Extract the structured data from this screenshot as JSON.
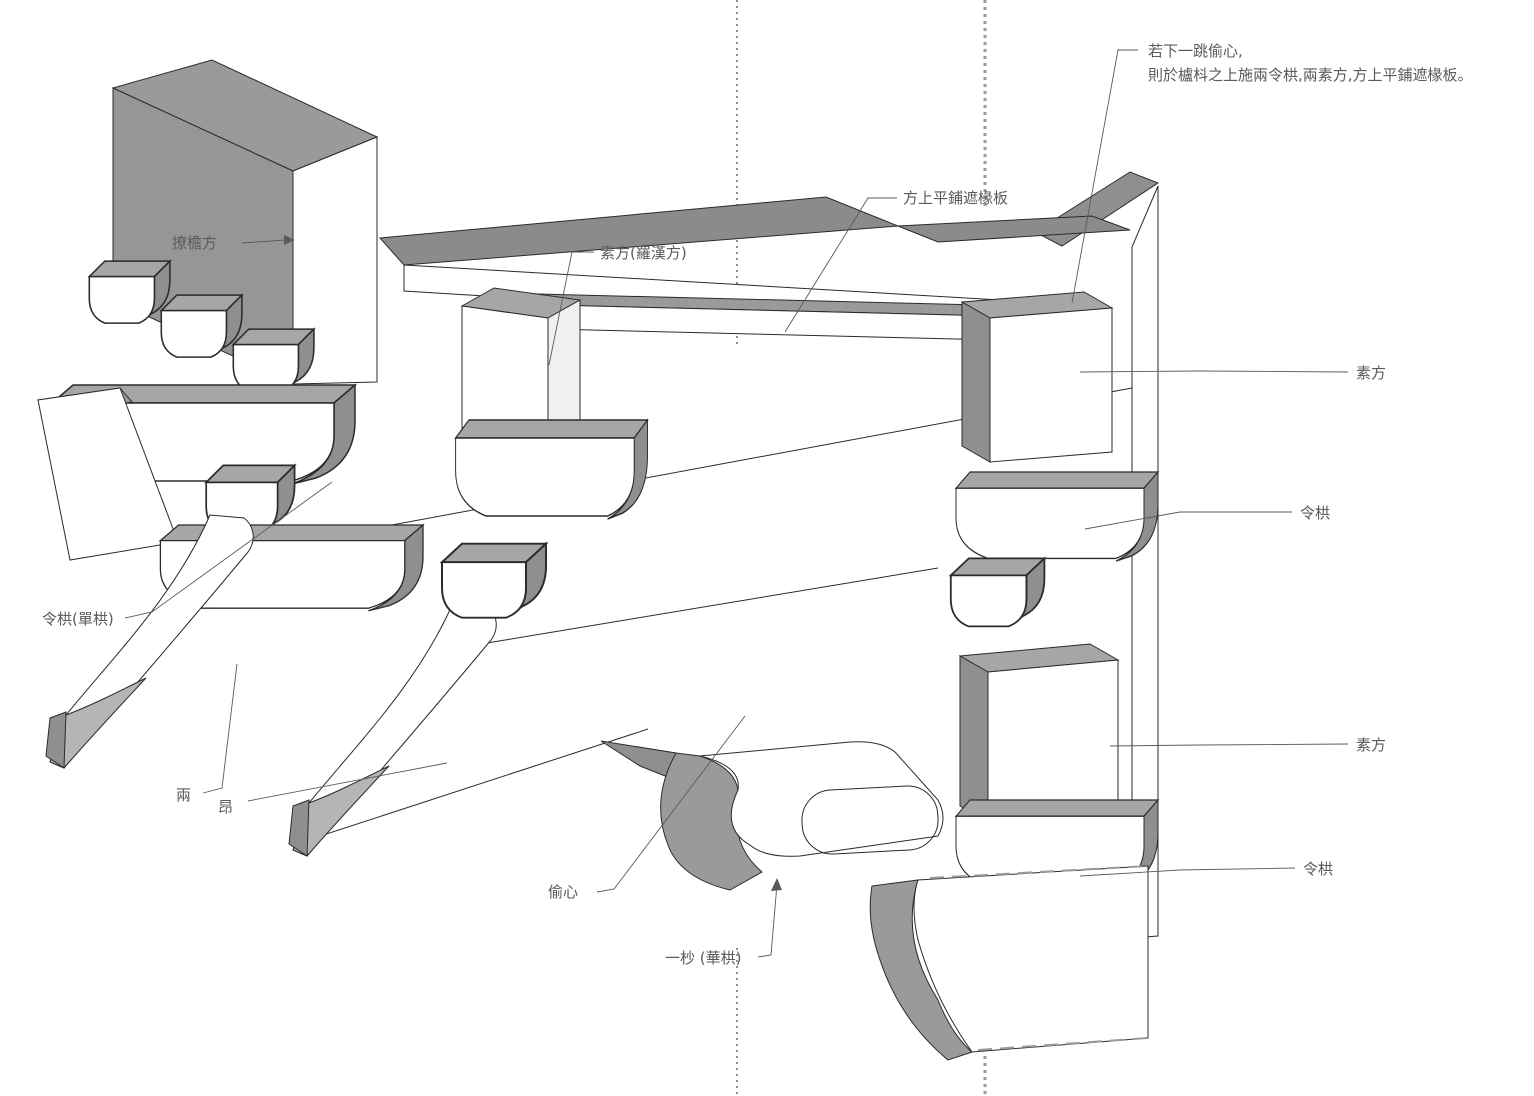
{
  "figure": {
    "note": {
      "line1": "若下一跳偷心,",
      "line2": "則於櫨枓之上施兩令栱,兩素方,方上平鋪遮椽板。"
    },
    "labels": {
      "fang_shang_zhechuanban": "方上平鋪遮椽板",
      "sufang_luohanfang": "素方(羅漢方)",
      "liaoyanfang": "撩檐方",
      "sufang_upper": "素方",
      "linggong_upper": "令栱",
      "sufang_lower": "素方",
      "linggong_lower": "令栱",
      "linggong_dangong": "令栱(單栱)",
      "liang": "兩",
      "ang": "昂",
      "touxin": "偷心",
      "yimiao_huagong": "一杪 (華栱)"
    },
    "colors": {
      "background": "#ffffff",
      "face_white": "#ffffff",
      "face_shaded": "#8f8f8f",
      "face_top": "#a6a6a6",
      "outline": "#2b2b2b",
      "label_text": "#5a5a5a",
      "leader_line": "#5a5a5a",
      "guide_dotted_dark": "#444444",
      "guide_dotted_gray": "#9a9a9a"
    }
  }
}
